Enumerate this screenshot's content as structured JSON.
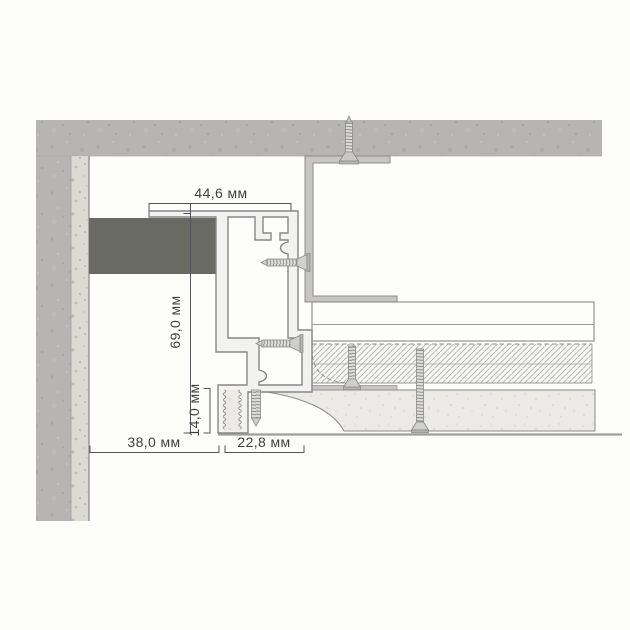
{
  "drawing": {
    "type": "ceiling-shadow-gap-profile-cross-section",
    "labels": {
      "dim_top_width": "44,6 мм",
      "dim_total_height": "69,0 мм",
      "dim_edge_height": "14,0 мм",
      "dim_wall_offset": "38,0 мм",
      "dim_base_width": "22,8 мм"
    },
    "colors": {
      "concrete": "#b6b5b3",
      "wall_plaster": "#dcdad4",
      "mounting_bracket": "#c6c5c3",
      "profile_fill": "#f2f2f0",
      "profile_outline": "#87878a",
      "dark_insert": "#6a6a64",
      "drywall": "#fdfdfc",
      "putty_finish": "#ebeae6",
      "hatch_line": "#b0afac",
      "dimension_text": "#3f3f3f",
      "dimension_line": "#55555a"
    }
  }
}
